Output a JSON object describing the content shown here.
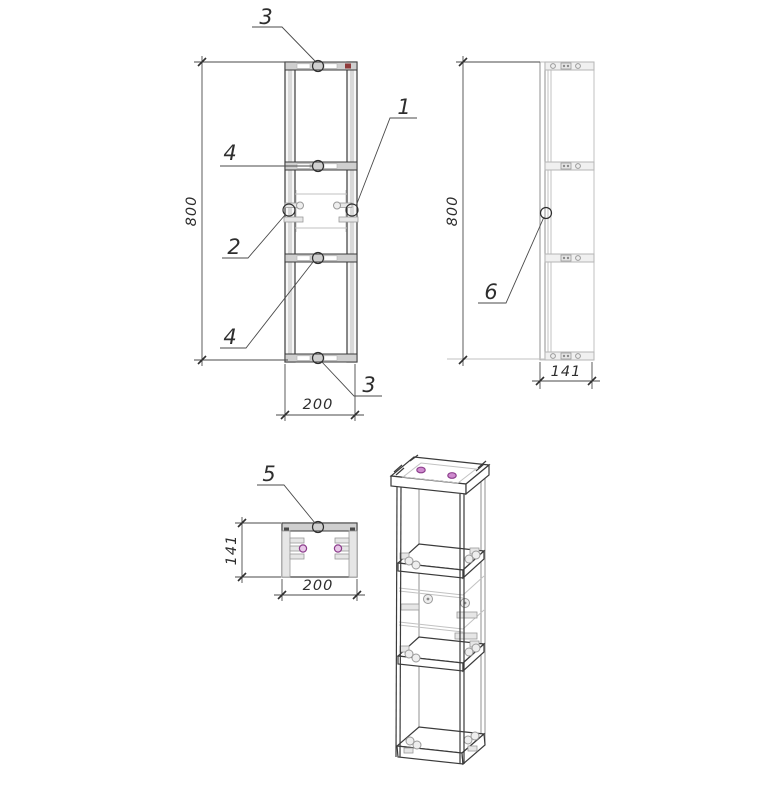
{
  "drawing_type": "furniture assembly technical drawing",
  "views": {
    "front": {
      "label_height": "800",
      "label_width": "200"
    },
    "side": {
      "label_height": "800",
      "label_depth": "141"
    },
    "plan": {
      "label_depth": "141",
      "label_width": "200"
    }
  },
  "callouts": {
    "top_rail": "3",
    "shelf_upper": "4",
    "left_cam": "2",
    "right_cam": "1",
    "shelf_lower": "4",
    "bottom_rail": "3",
    "plan_screw": "5",
    "side_cam": "6"
  },
  "colors": {
    "line": "#3b3b3b",
    "light_line": "#c2c2c2",
    "gray_fill": "#cfcfcf",
    "screw_purple": "#8d3f8d",
    "screw_purple_fill": "#cf8bcf",
    "mark_red": "#8f3a3a",
    "background": "#ffffff"
  }
}
